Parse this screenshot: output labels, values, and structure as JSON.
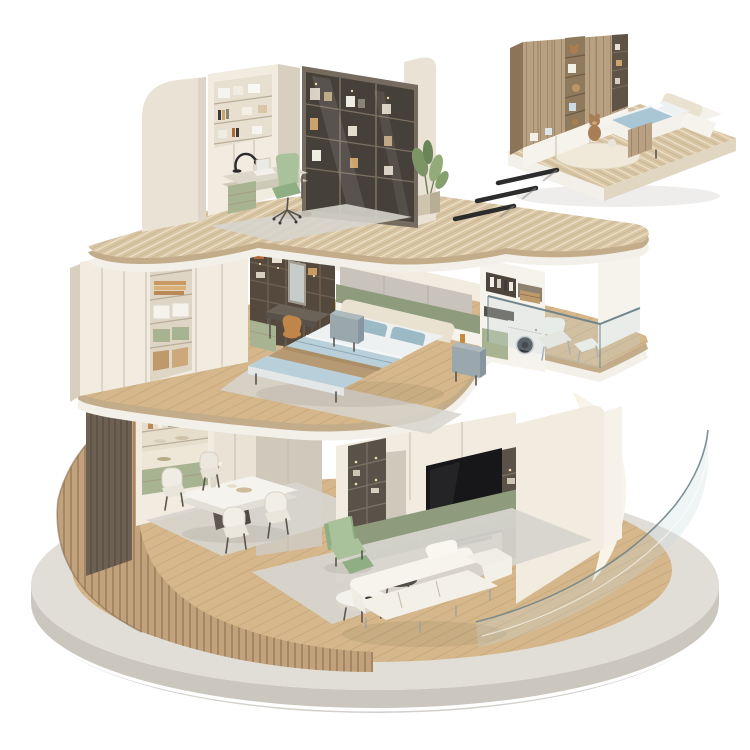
{
  "colors": {
    "background": "#ffffff",
    "wall_cream": "#e9e2d5",
    "wall_cream_light": "#f1ebe0",
    "wall_cream_dark": "#d8cfc0",
    "wall_white": "#f6f3ec",
    "fascia_white": "#f3f0e9",
    "slab_travertine": "#d9c6a5",
    "slab_travertine_dark": "#c2ac89",
    "wood_floor": "#d5b78b",
    "slat_wood": "#c2a27d",
    "dark_panel": "#6e6154",
    "concrete_top": "#e1ded7",
    "concrete_side": "#cbc7bf",
    "concrete_dark": "#b5b1a8",
    "olive": "#8e9b7c",
    "sage": "#a7b391",
    "green_chair": "#a9c29b",
    "green_chair_dark": "#8fae83",
    "bed_blue": "#b9cfd9",
    "bed_blue_dark": "#9cb9c6",
    "bed_white": "#eef1f2",
    "throw_tan": "#b69a74",
    "headboard_cream": "#eae2d1",
    "bronze_dark": "#5a5248",
    "bronze_mid": "#756b5e",
    "tv_black": "#17171a",
    "glass_fill": "rgba(196,216,220,0.28)",
    "glass_edge": "#70858b",
    "rug_grey": "#d7d5ce",
    "rug_grey_dark": "#c9c6bf",
    "inset_wood": "#b8a183",
    "inset_wood_dark": "#9a8466",
    "orange_chair": "#c08548",
    "metal": "#8a9095",
    "arrow_dark": "#2c2c2c",
    "ivory_backdrop": "#f8f4e8",
    "soft_shadow": "rgba(90,80,60,0.10)"
  },
  "scene": {
    "aria": "Isometric 3D cutaway render of a three-storey apartment on a round concrete plinth, with a detached kids bedroom module at top right linked by three motion dashes",
    "base": {
      "shape": "circular concrete plinth",
      "floor_material": "light oak planks"
    },
    "floors": [
      {
        "name": "ground floor",
        "areas": [
          {
            "name": "dining area",
            "objects": [
              "dark slat wall panel",
              "display cabinet with green drawers",
              "marble dining table",
              "four cream chairs",
              "flower vase",
              "area rug",
              "curved wood-slat perimeter wall"
            ]
          },
          {
            "name": "living room",
            "objects": [
              "media wall with lit shelves",
              "television",
              "olive base cabinet",
              "green recliner armchair",
              "white sofa",
              "marble coffee table",
              "dark glass side table",
              "area rug",
              "curved glass balustrade",
              "cream facade wall"
            ]
          }
        ]
      },
      {
        "name": "middle floor",
        "areas": [
          {
            "name": "walk-in closet",
            "objects": [
              "white wardrobe bank with open bay",
              "bronze open shelving",
              "dressing table with mirror",
              "orange stool",
              "green drawer unit"
            ]
          },
          {
            "name": "bedroom",
            "objects": [
              "upholstered headboard wall",
              "double bed with blue bedding and tan throw",
              "two grey nightstands",
              "area rug"
            ]
          },
          {
            "name": "laundry balcony",
            "objects": [
              "laundry cabinet with towels",
              "washing machine",
              "sage cabinet",
              "white lounge chair with ottoman",
              "glass balustrade",
              "wood deck"
            ]
          }
        ]
      },
      {
        "name": "top floor",
        "areas": [
          {
            "name": "study",
            "objects": [
              "curved cream outer walls",
              "wall shelving with boxes and books",
              "glass-door bookcase",
              "desk with black lamp and laptop",
              "green office chair",
              "sage desk cabinet",
              "grey rug",
              "potted plant"
            ]
          }
        ]
      }
    ],
    "detached_module": {
      "name": "kids bedroom module",
      "objects": [
        "wood wardrobe with toy shelves",
        "teddy bears",
        "platform bed with blue bedding",
        "white storage bench",
        "round rug",
        "travertine platform"
      ]
    },
    "arrows": {
      "count": 3,
      "meaning": "exploded-view link between module and building"
    }
  }
}
